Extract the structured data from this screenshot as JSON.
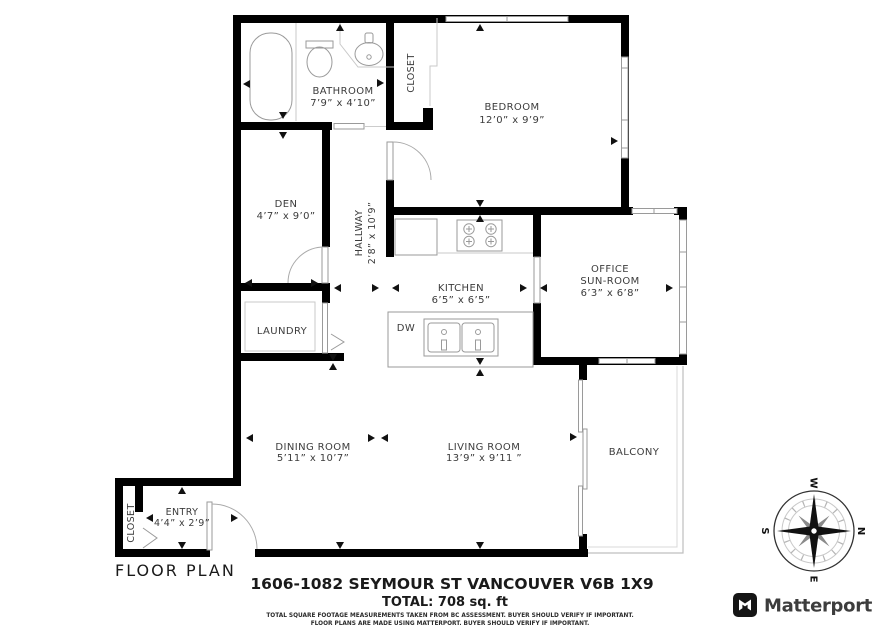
{
  "plan": {
    "title": "FLOOR PLAN",
    "address": "1606-1082 SEYMOUR ST VANCOUVER V6B 1X9",
    "total": "TOTAL: 708 sq. ft",
    "disclaimer1": "TOTAL SQUARE FOOTAGE MEASUREMENTS TAKEN FROM BC ASSESSMENT. BUYER SHOULD VERIFY IF IMPORTANT.",
    "disclaimer2": "FLOOR PLANS ARE MADE USING MATTERPORT. BUYER SHOULD VERIFY IF IMPORTANT."
  },
  "rooms": {
    "bathroom": {
      "name": "BATHROOM",
      "dims": "7’9” x 4’10”"
    },
    "closet_top": {
      "name": "CLOSET"
    },
    "bedroom": {
      "name": "BEDROOM",
      "dims": "12’0” x 9’9”"
    },
    "den": {
      "name": "DEN",
      "dims": "4’7” x 9’0”"
    },
    "hallway": {
      "name": "HALLWAY",
      "dims": "2’8” x 10’9”"
    },
    "kitchen": {
      "name": "KITCHEN",
      "dims": "6’5” x 6’5”"
    },
    "office": {
      "name1": "OFFICE",
      "name2": "SUN-ROOM",
      "dims": "6’3” x 6’8”"
    },
    "laundry": {
      "name": "LAUNDRY"
    },
    "dishwasher": {
      "label": "DW"
    },
    "dining": {
      "name": "DINING ROOM",
      "dims": "5’11” x 10’7”"
    },
    "living": {
      "name": "LIVING ROOM",
      "dims": "13’9” x 9’11 ”"
    },
    "balcony": {
      "name": "BALCONY"
    },
    "entry": {
      "name": "ENTRY",
      "dims": "4’4” x 2’9”"
    },
    "closet_entry": {
      "name": "CLOSET"
    }
  },
  "compass": {
    "n": "N",
    "e": "E",
    "s": "S",
    "w": "W"
  },
  "brand": {
    "wordmark": "Matterport"
  },
  "colors": {
    "wall": "#000000",
    "fixture_line": "#9a9a9a",
    "label_text": "#3c3c3c",
    "brand_text": "#3d3d3d"
  }
}
